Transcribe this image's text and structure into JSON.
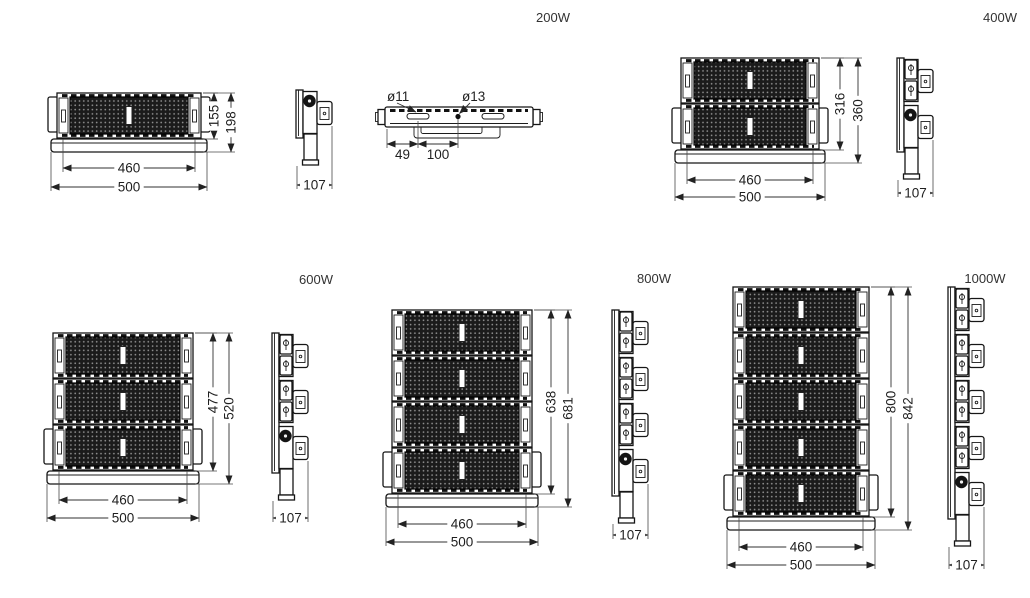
{
  "colors": {
    "background": "#ffffff",
    "line_color": "#1a1a1a",
    "text_color": "#2e2e2e"
  },
  "products": [
    {
      "id": "200w",
      "label": "200W",
      "front_dims": {
        "inner_width": "460",
        "outer_width": "500",
        "module_height": "155",
        "overall_height": "198"
      },
      "side_dim": {
        "depth": "107"
      },
      "top_view": {
        "slot_diameter": "ø11",
        "hole_diameter": "ø13",
        "slot_offset": "49",
        "hole_pitch": "100"
      }
    },
    {
      "id": "400w",
      "label": "400W",
      "front_dims": {
        "inner_width": "460",
        "outer_width": "500",
        "module_height": "316",
        "overall_height": "360"
      },
      "side_dim": {
        "depth": "107"
      }
    },
    {
      "id": "600w",
      "label": "600W",
      "front_dims": {
        "inner_width": "460",
        "outer_width": "500",
        "module_height": "477",
        "overall_height": "520"
      },
      "side_dim": {
        "depth": "107"
      }
    },
    {
      "id": "800w",
      "label": "800W",
      "front_dims": {
        "inner_width": "460",
        "outer_width": "500",
        "module_height": "638",
        "overall_height": "681"
      },
      "side_dim": {
        "depth": "107"
      }
    },
    {
      "id": "1000w",
      "label": "1000W",
      "front_dims": {
        "inner_width": "460",
        "outer_width": "500",
        "module_height": "800",
        "overall_height": "842"
      },
      "side_dim": {
        "depth": "107"
      }
    }
  ]
}
